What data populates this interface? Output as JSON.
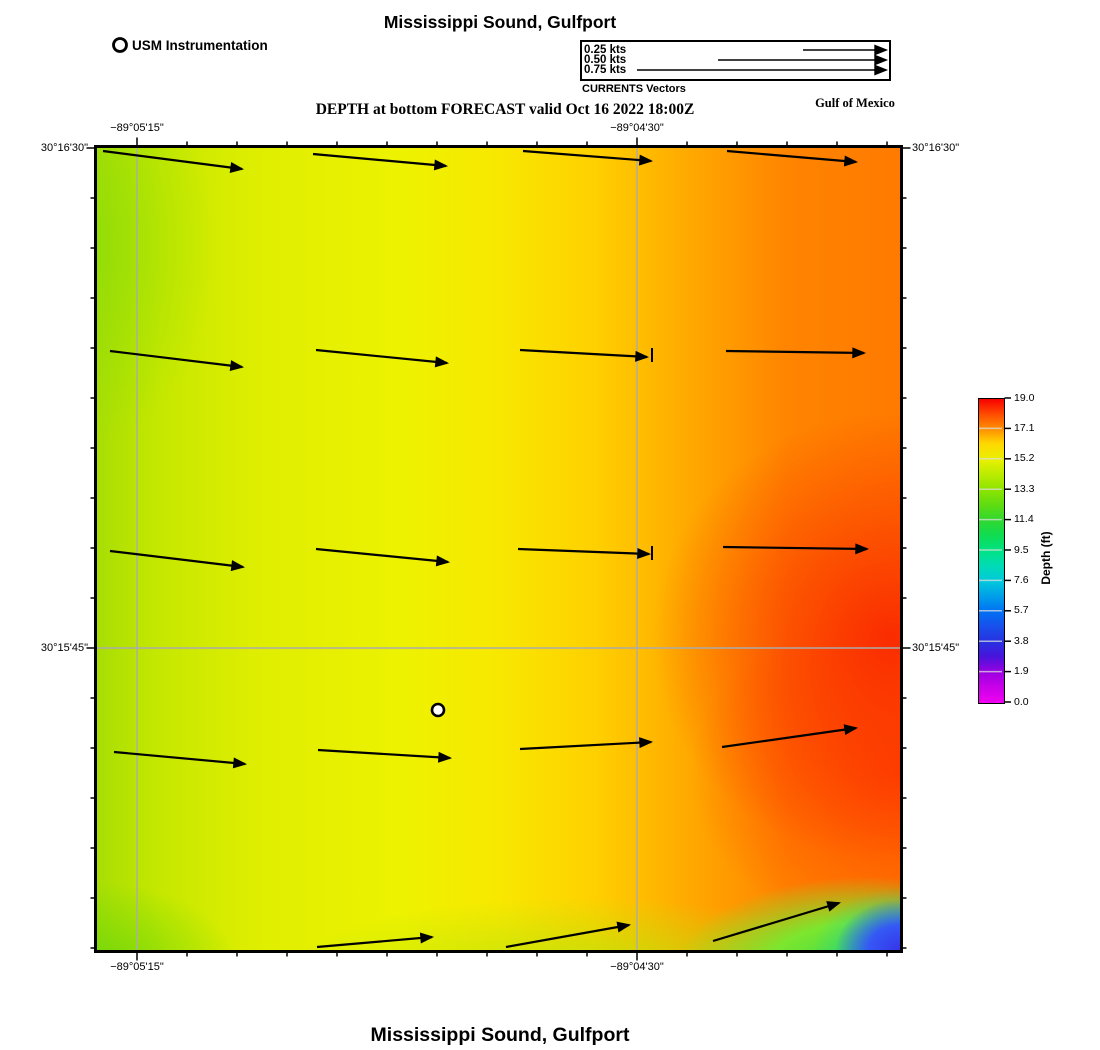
{
  "header": {
    "title": "Mississippi Sound, Gulfport",
    "usm_legend_label": "USM Instrumentation",
    "currents_caption": "CURRENTS Vectors",
    "depth_caption": "DEPTH at bottom FORECAST valid Oct 16 2022 18:00Z",
    "region_label": "Gulf of Mexico"
  },
  "footer": {
    "title": "Mississippi Sound, Gulfport"
  },
  "vector_legend": {
    "entries": [
      {
        "label": "0.25 kts",
        "tail_x": 803,
        "y": 50
      },
      {
        "label": "0.50 kts",
        "tail_x": 718,
        "y": 60
      },
      {
        "label": "0.75 kts",
        "tail_x": 637,
        "y": 70
      }
    ],
    "head_x": 886,
    "marker": {
      "cx": 120,
      "cy": 45,
      "r": 6.5
    }
  },
  "chart_data": {
    "type": "heatmap",
    "subtype": "geographic-depth-forecast-with-current-vectors",
    "title": "Mississippi Sound, Gulfport",
    "subtitle": "DEPTH at bottom FORECAST valid Oct 16 2022 18:00Z",
    "map_px": {
      "left": 97,
      "top": 148,
      "right": 900,
      "bottom": 950
    },
    "x_ticks": [
      {
        "label": "−89°05'15\"",
        "px": 137
      },
      {
        "label": "−89°04'30\"",
        "px": 637
      }
    ],
    "y_ticks": [
      {
        "label": "30°16'30\"",
        "px": 148
      },
      {
        "label": "30°15'45\"",
        "px": 648
      }
    ],
    "grid": {
      "x": [
        137,
        637
      ],
      "y": [
        648
      ],
      "color": "#ababab"
    },
    "minor_tick_step_px": 50,
    "vectors_px": [
      [
        103,
        151,
        242,
        169
      ],
      [
        313,
        154,
        446,
        166
      ],
      [
        523,
        151,
        651,
        161
      ],
      [
        727,
        151,
        856,
        162
      ],
      [
        110,
        351,
        242,
        367
      ],
      [
        316,
        350,
        447,
        363
      ],
      [
        520,
        350,
        647,
        357
      ],
      [
        726,
        351,
        864,
        353
      ],
      [
        110,
        551,
        243,
        567
      ],
      [
        316,
        549,
        448,
        562
      ],
      [
        518,
        549,
        649,
        554
      ],
      [
        723,
        547,
        867,
        549
      ],
      [
        114,
        752,
        245,
        764
      ],
      [
        318,
        750,
        450,
        758
      ],
      [
        520,
        749,
        651,
        742
      ],
      [
        722,
        747,
        856,
        728
      ],
      [
        317,
        947,
        432,
        937
      ],
      [
        506,
        947,
        629,
        925
      ],
      [
        713,
        941,
        839,
        903
      ]
    ],
    "vector_stubs_px": [
      [
        652,
        348,
        652,
        362
      ],
      [
        652,
        546,
        652,
        560
      ]
    ],
    "stations_px": [
      [
        438,
        710
      ]
    ],
    "colorbar": {
      "title": "Depth (ft)",
      "min": 0.0,
      "max": 19.0,
      "ticks": [
        "19.0",
        "17.1",
        "15.2",
        "13.3",
        "11.4",
        "9.5",
        "7.6",
        "5.7",
        "3.8",
        "1.9",
        "0.0"
      ],
      "px": {
        "x": 978,
        "y": 398,
        "w": 25,
        "h": 304
      },
      "stops": [
        [
          0.0,
          "#f000f0"
        ],
        [
          1.0,
          "#c800e8"
        ],
        [
          1.9,
          "#9c00e0"
        ],
        [
          2.9,
          "#4814dc"
        ],
        [
          3.8,
          "#2830e0"
        ],
        [
          4.8,
          "#1850ec"
        ],
        [
          5.7,
          "#0070f4"
        ],
        [
          6.7,
          "#00a0e8"
        ],
        [
          7.6,
          "#00c8dc"
        ],
        [
          8.6,
          "#00dcb4"
        ],
        [
          9.5,
          "#00e284"
        ],
        [
          10.5,
          "#10dc50"
        ],
        [
          11.4,
          "#30d830"
        ],
        [
          12.4,
          "#60dc10"
        ],
        [
          13.3,
          "#8ce400"
        ],
        [
          14.3,
          "#bcec00"
        ],
        [
          15.2,
          "#e8f000"
        ],
        [
          16.2,
          "#ffd800"
        ],
        [
          17.1,
          "#ff9000"
        ],
        [
          18.0,
          "#ff5000"
        ],
        [
          19.0,
          "#f80000"
        ]
      ]
    }
  }
}
